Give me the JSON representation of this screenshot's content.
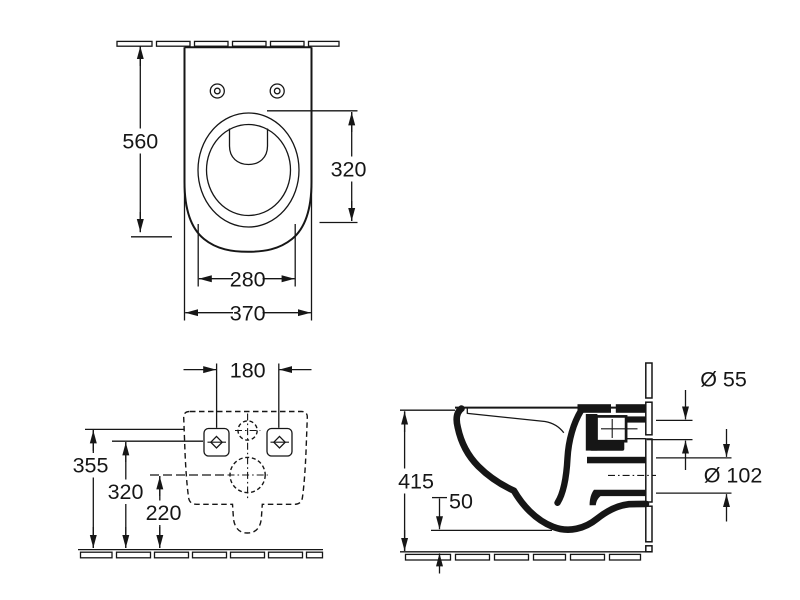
{
  "colors": {
    "ink": "#161616",
    "background": "#ffffff"
  },
  "views": {
    "top": {
      "dim_depth": "560",
      "dim_bowl_length": "320",
      "dim_bowl_width": "280",
      "dim_body_width": "370"
    },
    "rear": {
      "dim_fixing_spacing": "180",
      "dim_inlet_height": "355",
      "dim_fixing_height": "320",
      "dim_outlet_height": "220"
    },
    "side": {
      "dim_height": "415",
      "dim_bottom_gap": "50",
      "dim_inlet_diameter": "Ø 55",
      "dim_outlet_diameter": "Ø 102"
    }
  }
}
